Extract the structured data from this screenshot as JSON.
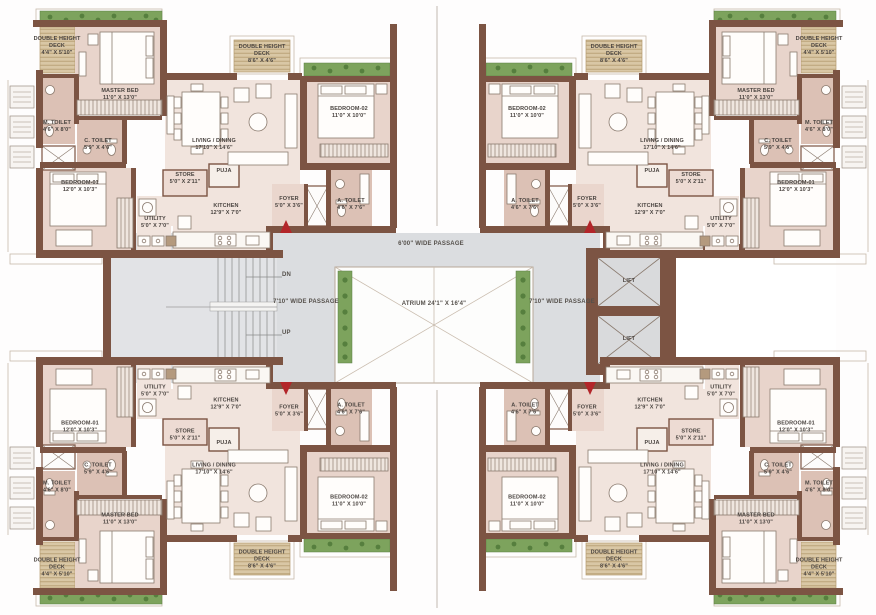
{
  "unit": {
    "master_bed": {
      "name": "MASTER BED",
      "dim": "11'0\" X 13'0\""
    },
    "bedroom_01": {
      "name": "BEDROOM-01",
      "dim": "12'0\" X 10'3\""
    },
    "bedroom_02": {
      "name": "BEDROOM-02",
      "dim": "11'0\" X 10'0\""
    },
    "living_dining": {
      "name": "LIVING / DINING",
      "dim": "17'10\" X 14'6\""
    },
    "kitchen": {
      "name": "KITCHEN",
      "dim": "12'9\" X 7'0\""
    },
    "utility": {
      "name": "UTILITY",
      "dim": "5'0\" X 7'0\""
    },
    "store": {
      "name": "STORE",
      "dim": "5'0\" X 2'11\""
    },
    "puja": {
      "name": "PUJA",
      "dim": ""
    },
    "foyer": {
      "name": "FOYER",
      "dim": "5'0\" X 3'6\""
    },
    "m_toilet": {
      "name": "M. TOILET",
      "dim": "4'6\" X 8'0\""
    },
    "c_toilet": {
      "name": "C. TOILET",
      "dim": "5'9\" X 4'6\""
    },
    "a_toilet": {
      "name": "A. TOILET",
      "dim": "4'6\" X 7'6\""
    },
    "deck_master": {
      "name": "DOUBLE HEIGHT DECK",
      "dim": "4'4\" X 5'10\""
    },
    "deck_living": {
      "name": "DOUBLE HEIGHT DECK",
      "dim": "8'6\" X 4'6\""
    }
  },
  "core": {
    "passage_top": "6'00\" WIDE PASSAGE",
    "passage_left": "7'10\" WIDE PASSAGE",
    "passage_right": "7'10\" WIDE PASSAGE",
    "atrium": "ATRIUM   24'1\" X 16'4\"",
    "lift": "LIFT",
    "dn": "DN",
    "up": "UP"
  },
  "colors": {
    "wall": "#7c5443",
    "bedroom_fill": "#e8d4cb",
    "living_fill": "#f1e4dd",
    "toilet_fill": "#dcc1b5",
    "foyer_fill": "#ead6cd",
    "deck_fill": "#d9c7a5",
    "deck_line": "#b49a6e",
    "planter_green": "#7da35d",
    "passage_gray": "#dbdde0",
    "stair_fill": "#e2e3e6",
    "atrium_line": "#c9bcae",
    "entry_arrow_red": "#b3262a",
    "label_text": "#4a4440"
  }
}
